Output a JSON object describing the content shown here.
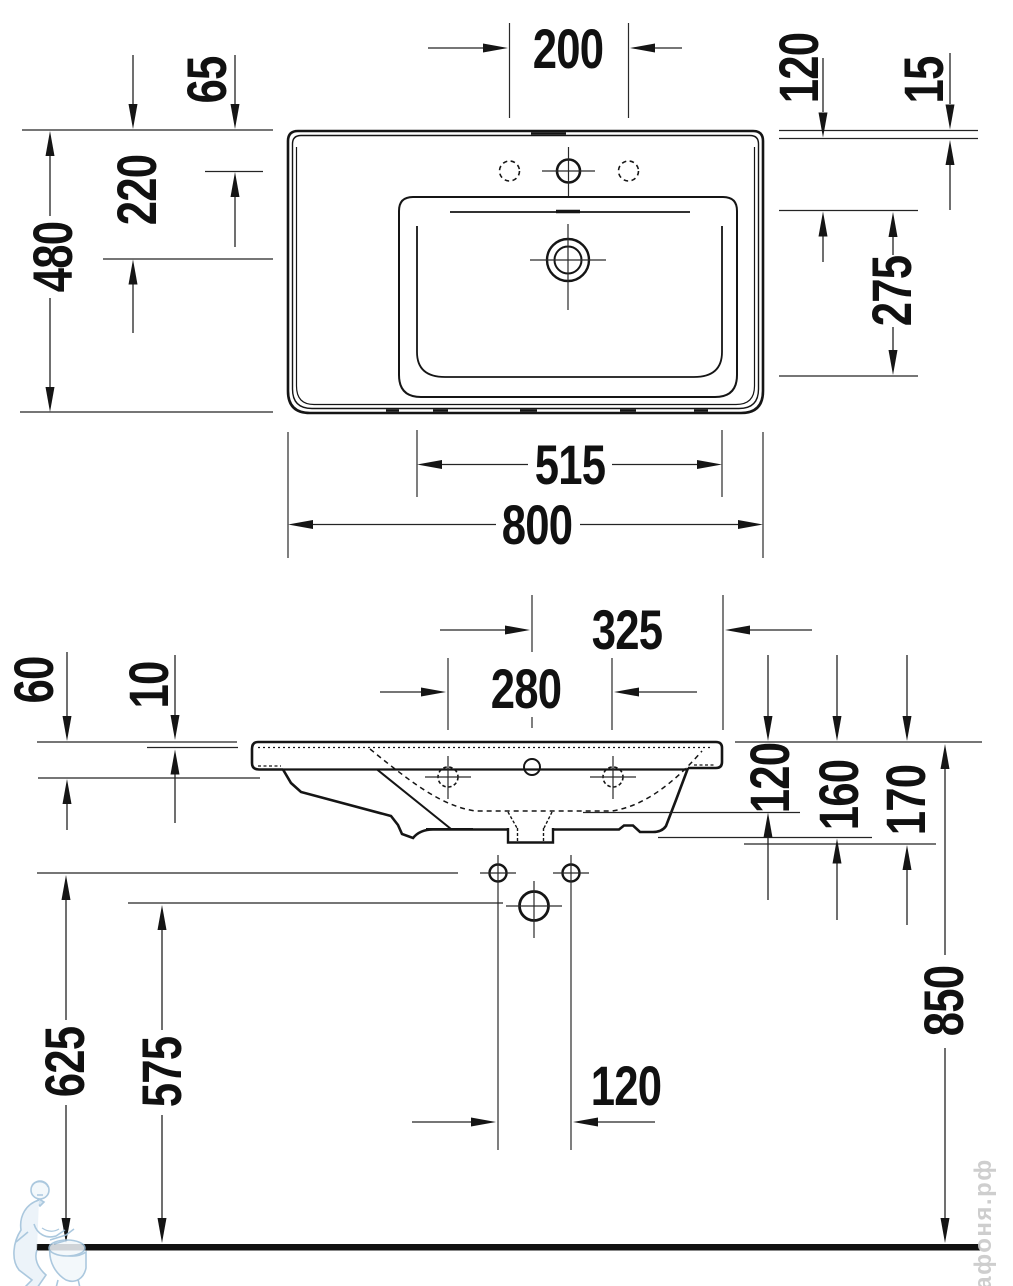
{
  "dimensions": {
    "plan_view": {
      "tap_hole_spacing": "200",
      "rear_to_tap_center": "65",
      "rear_to_drain_center": "220",
      "overall_depth": "480",
      "rear_ledge_depth": "120",
      "rear_rim_offset": "15",
      "bowl_depth": "275",
      "bowl_width": "515",
      "overall_width": "800"
    },
    "front_view": {
      "rim_drop": "60",
      "rim_thickness": "10",
      "center_to_edge": "325",
      "fixing_hole_spacing": "280",
      "bowl_inner_depth": "120",
      "height_to_underside": "160",
      "height_to_trap": "170",
      "rim_height": "850",
      "fixing_holes_height": "625",
      "drain_height": "575",
      "bottom_holes_spacing": "120"
    }
  },
  "watermark": {
    "site_text": "афоня.рф"
  }
}
